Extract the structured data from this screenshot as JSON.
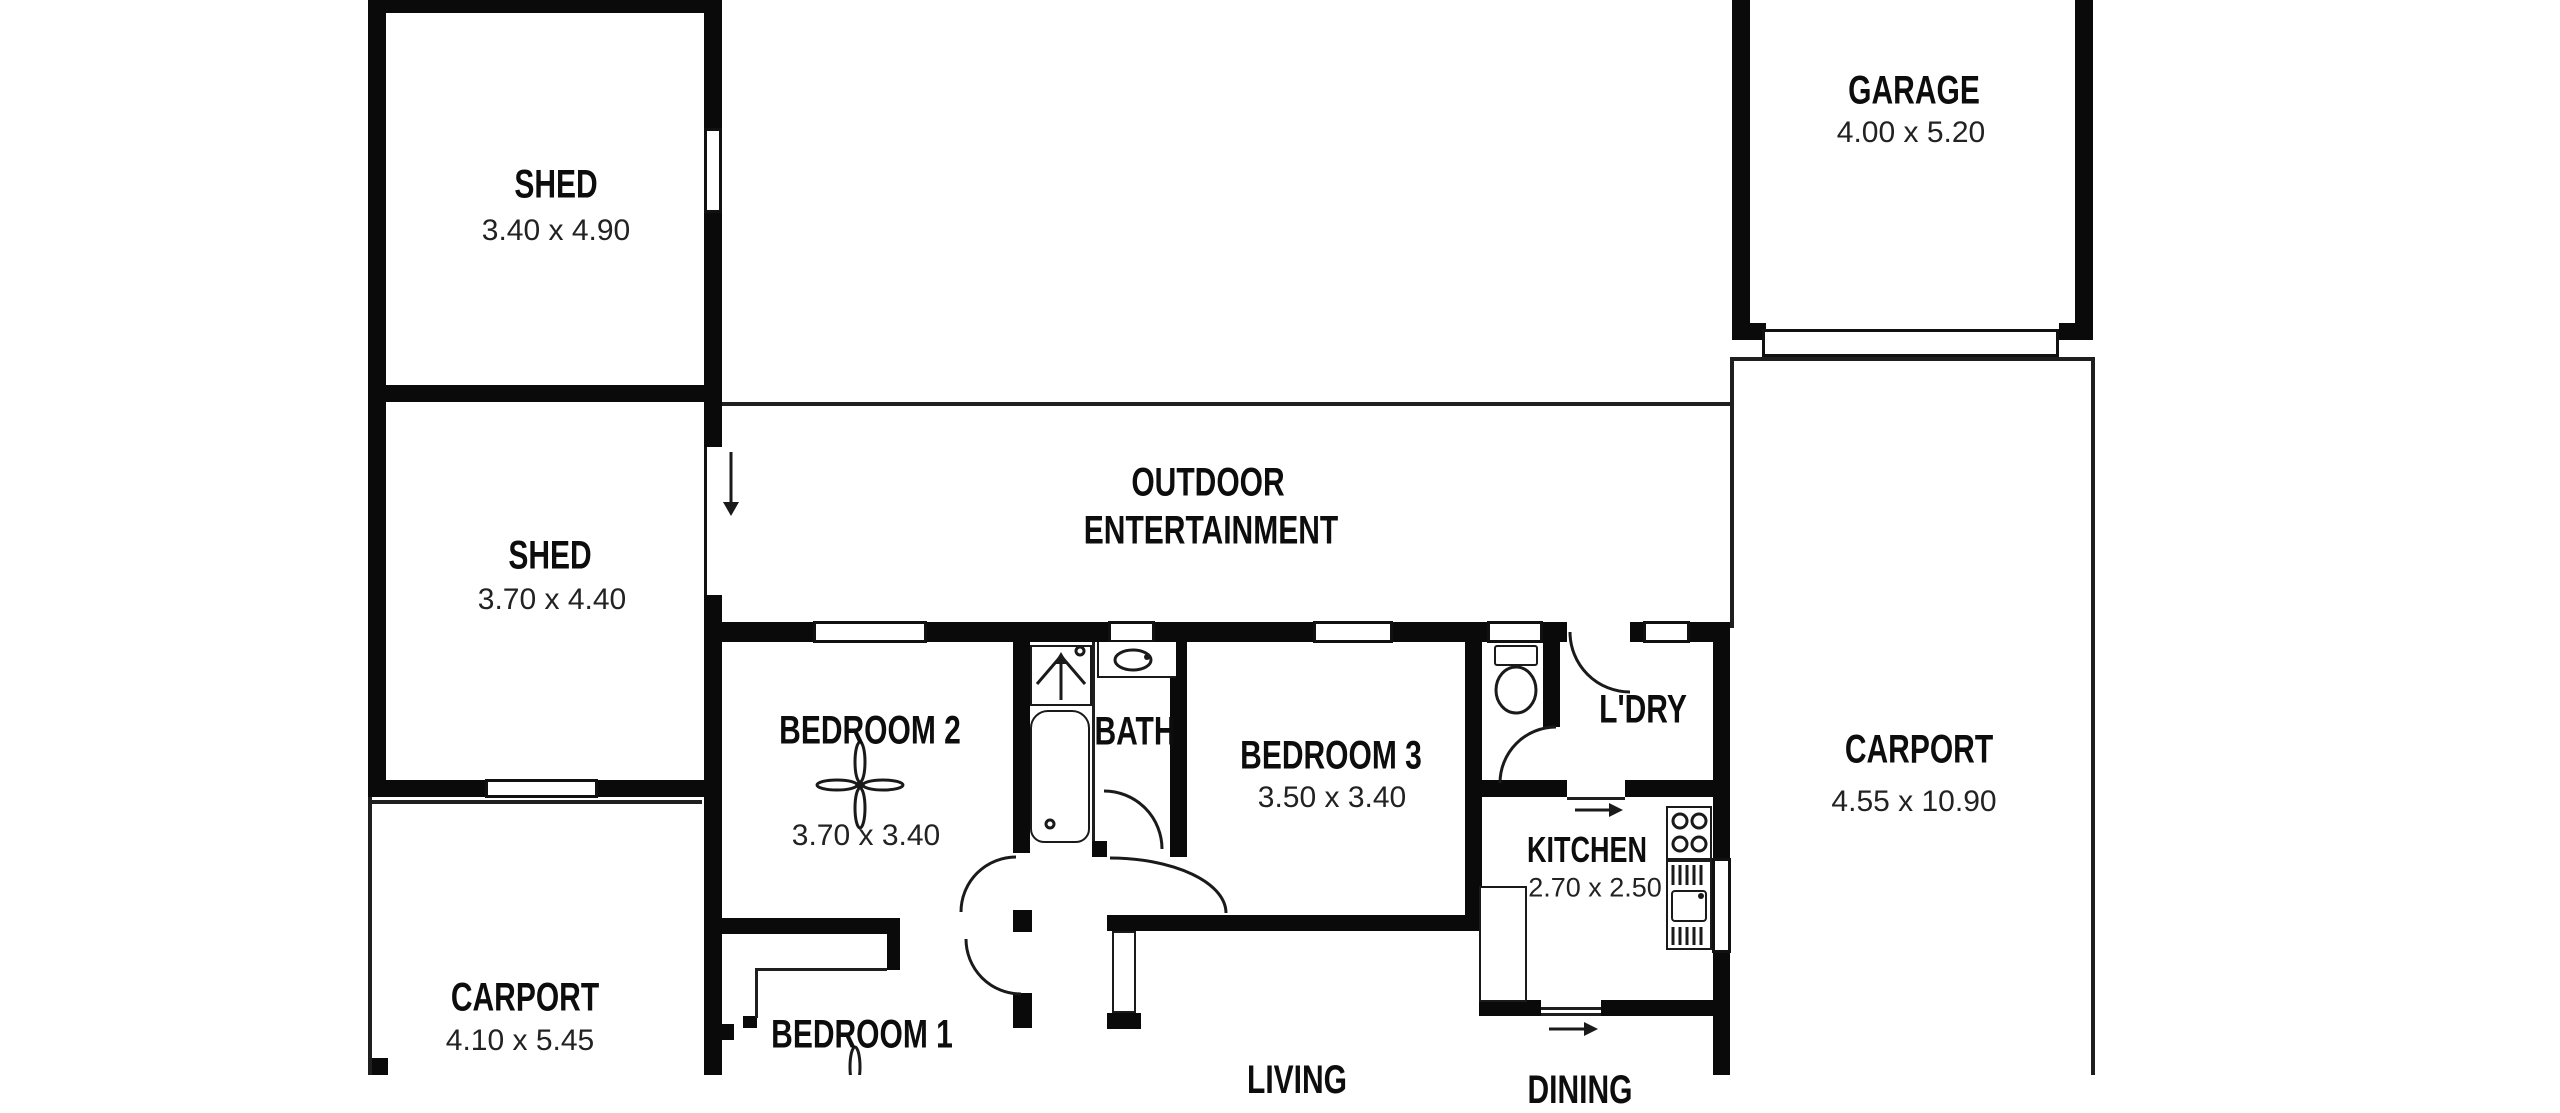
{
  "rooms": {
    "shed1": {
      "name": "SHED",
      "dims": "3.40 x 4.90"
    },
    "shed2": {
      "name": "SHED",
      "dims": "3.70 x 4.40"
    },
    "garage": {
      "name": "GARAGE",
      "dims": "4.00 x 5.20"
    },
    "outdoor": {
      "line1": "OUTDOOR",
      "line2": "ENTERTAINMENT"
    },
    "bedroom2": {
      "name": "BEDROOM 2",
      "dims": "3.70 x 3.40"
    },
    "bath": {
      "name": "BATH"
    },
    "bedroom3": {
      "name": "BEDROOM 3",
      "dims": "3.50 x 3.40"
    },
    "laundry": {
      "name": "L'DRY"
    },
    "kitchen": {
      "name": "KITCHEN",
      "dims": "2.70 x 2.50"
    },
    "carport_left": {
      "name": "CARPORT",
      "dims": "4.10 x 5.45"
    },
    "carport_right": {
      "name": "CARPORT",
      "dims": "4.55 x 10.90"
    },
    "bedroom1": {
      "name": "BEDROOM 1"
    },
    "living": {
      "name": "LIVING"
    },
    "dining": {
      "name": "DINING"
    }
  },
  "icons": {
    "ceiling_fan": "ceiling-fan-icon",
    "shower": "shower-icon",
    "bathtub": "bathtub-icon",
    "toilet": "toilet-icon",
    "basin": "basin-icon",
    "stove": "stove-icon",
    "double_sink": "double-sink-icon",
    "door_swing": "door-swing-arc",
    "entry_arrow": "entry-arrow-icon"
  },
  "colors": {
    "wall": "#0a0a0a",
    "line": "#1f1f1f",
    "background": "#ffffff"
  }
}
